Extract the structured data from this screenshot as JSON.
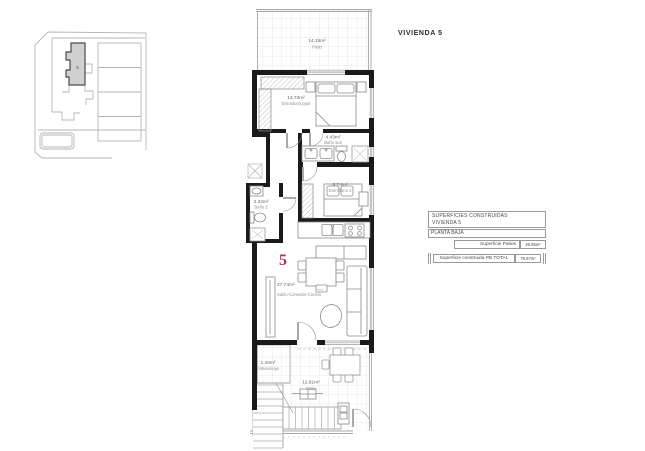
{
  "title": "VIVIENDA 5",
  "site_plan": {
    "unit_label": "5"
  },
  "unit_number": "5",
  "rooms": {
    "patio_top": {
      "area": "14.15m²",
      "name": "Patio"
    },
    "dormitorio_ppal": {
      "area": "13.73m²",
      "name": "Dormitorio ppal"
    },
    "bano_suit": {
      "area": "4.43m²",
      "name": "Baño suit"
    },
    "dormitorio_2": {
      "area": "8.74m²",
      "name": "Dormitorio 2"
    },
    "bano_2": {
      "area": "3.32m²",
      "name": "Baño 2"
    },
    "salon": {
      "area": "27.74m²",
      "name": "Salón-Comedor-Cocina"
    },
    "almacenaje": {
      "area": "1.40m²",
      "name": "Almacenaje"
    },
    "patio_bottom": {
      "area": "12.81m²",
      "name": "Patio"
    }
  },
  "annotation": "Acot.",
  "areas_table": {
    "header_line1": "SUPERFICIES CONSTRUIDAS",
    "header_line2": "VIVIENDA 5",
    "row_planta": "PLANTA BAJA",
    "row_patios_label": "Superficie Patios",
    "row_patios_value": "26.96m²",
    "row_total_label": "Superficie construida PB TOTAL",
    "row_total_value": "78.97m²"
  },
  "colors": {
    "wall": "#1a1a1a",
    "accent_unit_number": "#b53158",
    "line_gray": "#9a9a9a",
    "grid_gray": "#e0e0e0"
  }
}
